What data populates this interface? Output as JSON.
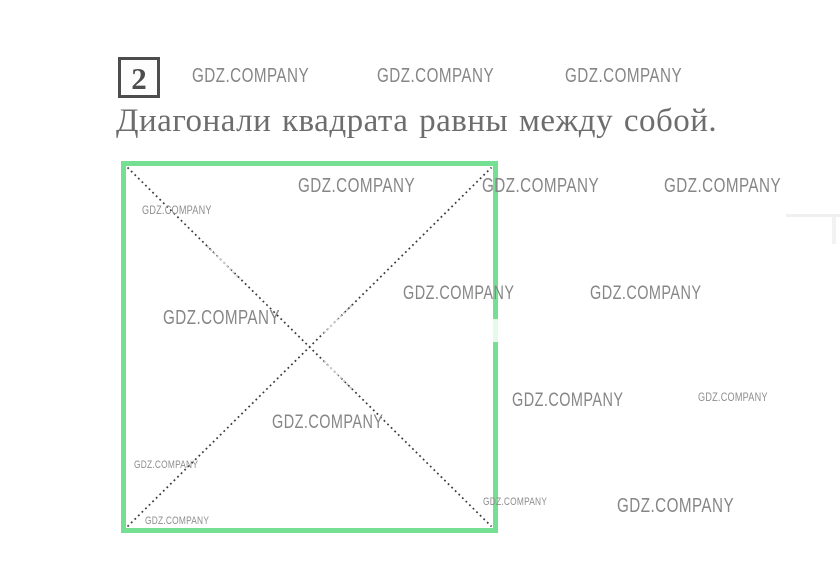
{
  "theme": {
    "background": "#ffffff",
    "accent_green": "#75e094",
    "watermark_color": "#868686",
    "ink_color": "#4d4d4d",
    "title_color": "#6d6d6d",
    "diagonal_color": "#3a3a3a",
    "diagonal_faded_color": "#cccccc"
  },
  "exercise": {
    "number": "2"
  },
  "statement": {
    "text": "Диагонали квадрата равны между собой."
  },
  "watermark": {
    "text": "GDZ.COMPANY"
  },
  "figure": {
    "shape": "square",
    "border_color": "#75e094",
    "diagonals": "two dotted diagonals joining opposite corners"
  }
}
